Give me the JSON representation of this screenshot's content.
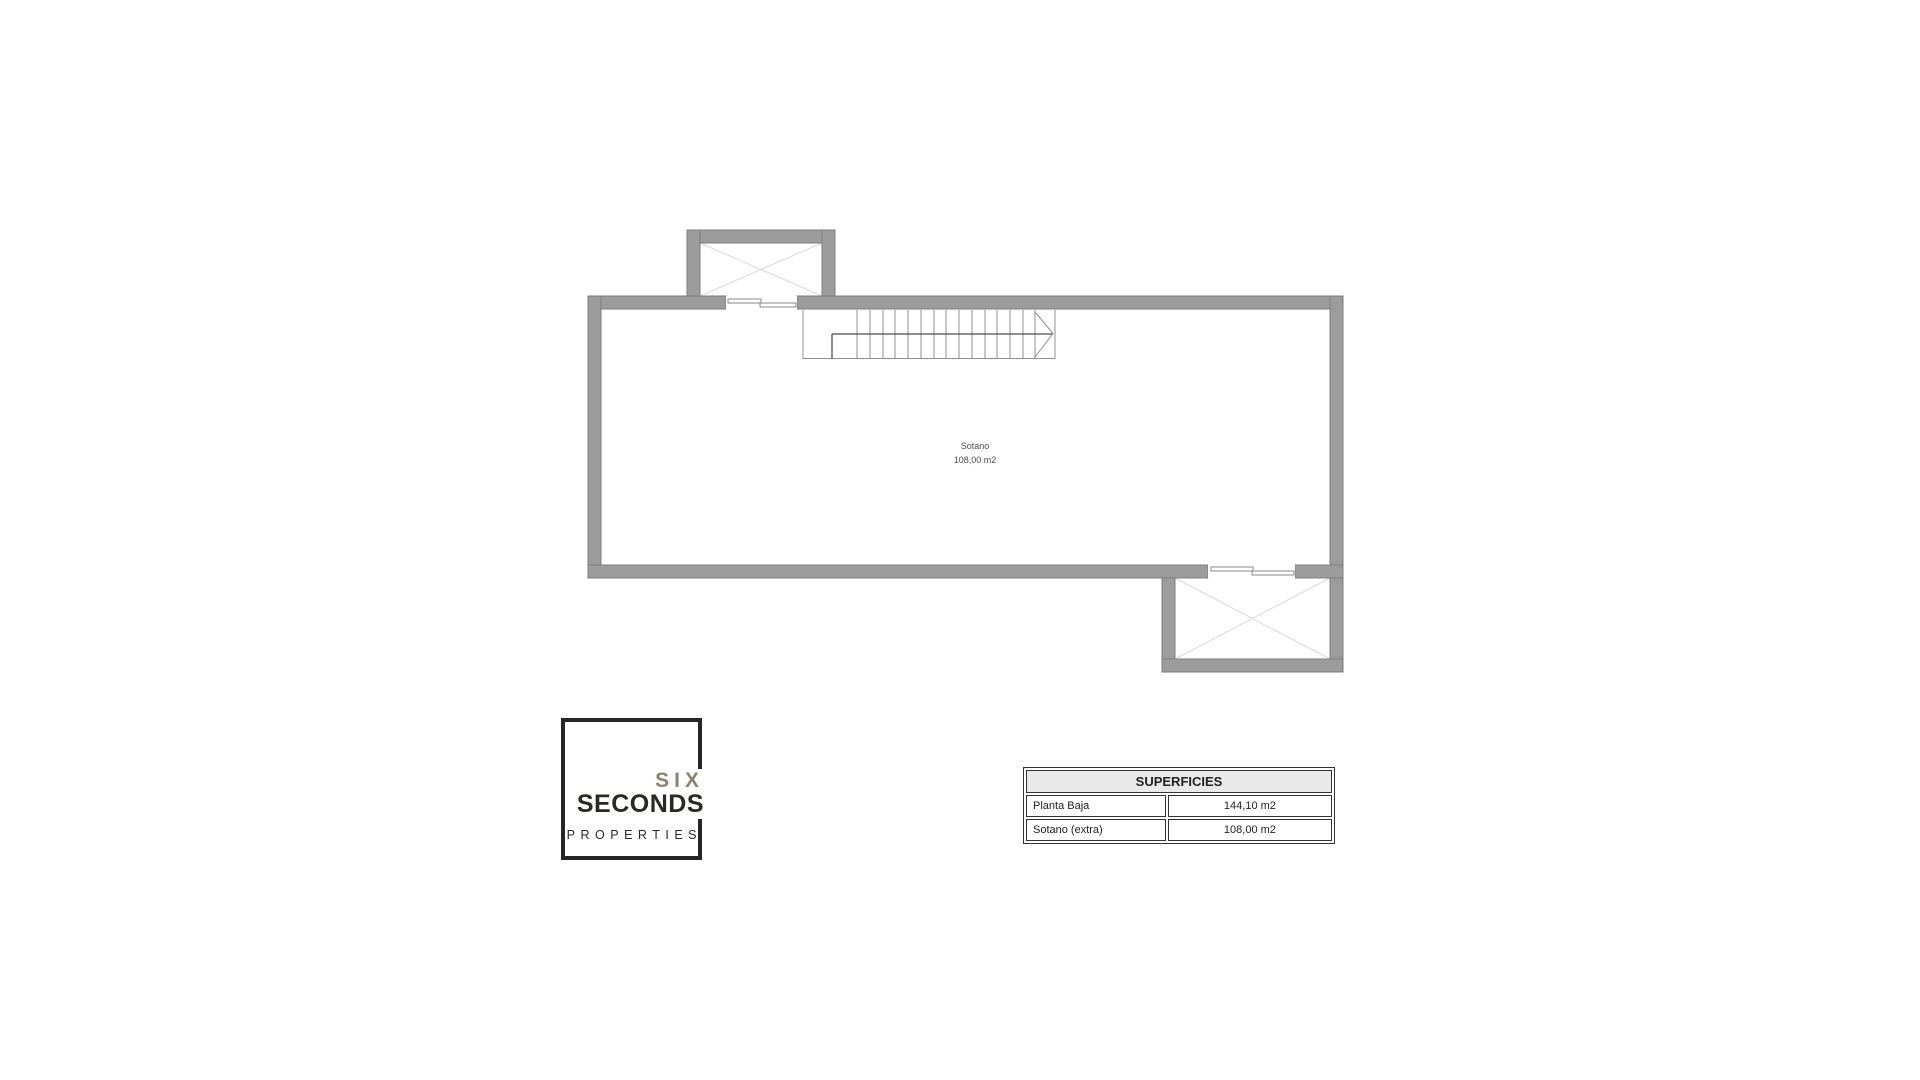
{
  "plan": {
    "room": {
      "name": "Sotano",
      "area": "108,00 m2"
    }
  },
  "logo": {
    "word1": "SIX",
    "word2": "SECONDS",
    "word3": "PROPERTIES"
  },
  "table": {
    "title": "SUPERFICIES",
    "rows": [
      {
        "label": "Planta Baja",
        "value": "144,10 m2"
      },
      {
        "label": "Sotano (extra)",
        "value": "108,00 m2"
      }
    ]
  },
  "colors": {
    "wall_fill": "#9c9c9c",
    "wall_edge": "#7e7e7e",
    "cross_line": "#d9d9d9",
    "stair_line": "#909090",
    "stair_dark_line": "#4e4e4e",
    "room_text": "#4c4c4c",
    "logo_dark": "#2b2926",
    "logo_gray": "#8b8273",
    "table_border": "#333333",
    "table_header_bg": "#e9e9e9"
  }
}
